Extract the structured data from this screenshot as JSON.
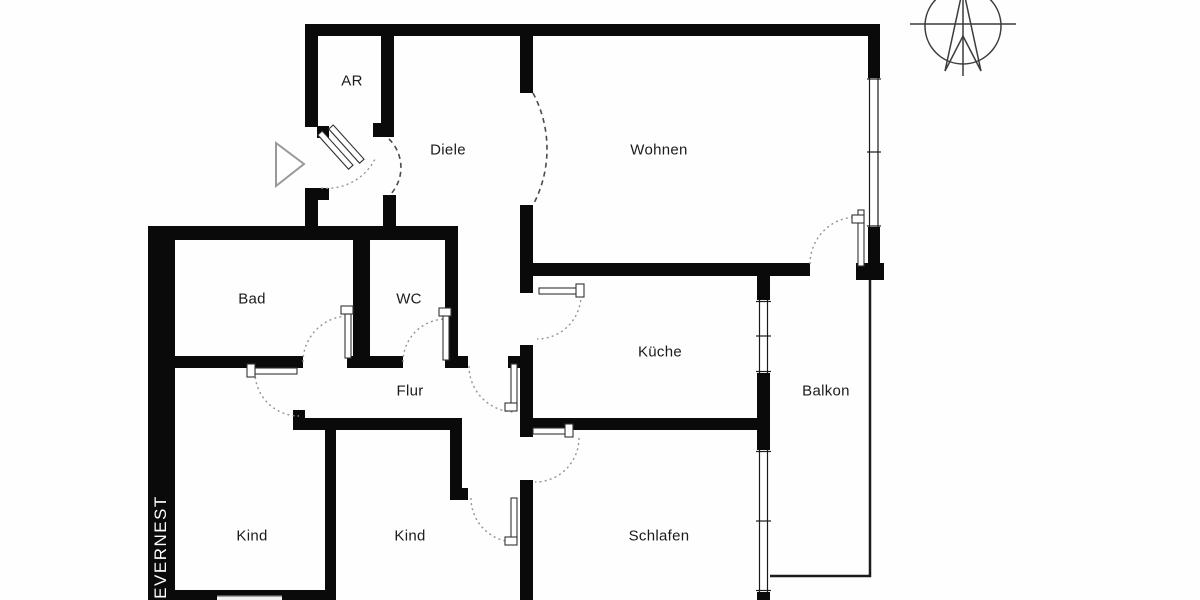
{
  "document": {
    "kind": "apartment floor plan",
    "language": "de"
  },
  "brand": {
    "name": "EVERNEST"
  },
  "rooms": [
    {
      "id": "ar",
      "name": "AR",
      "x": 352,
      "y": 81
    },
    {
      "id": "diele",
      "name": "Diele",
      "x": 448,
      "y": 150
    },
    {
      "id": "wohnen",
      "name": "Wohnen",
      "x": 659,
      "y": 150
    },
    {
      "id": "bad",
      "name": "Bad",
      "x": 252,
      "y": 299
    },
    {
      "id": "wc",
      "name": "WC",
      "x": 409,
      "y": 299
    },
    {
      "id": "kueche",
      "name": "Küche",
      "x": 660,
      "y": 352
    },
    {
      "id": "flur",
      "name": "Flur",
      "x": 410,
      "y": 391
    },
    {
      "id": "balkon",
      "name": "Balkon",
      "x": 826,
      "y": 391
    },
    {
      "id": "kind-1",
      "name": "Kind",
      "x": 252,
      "y": 536
    },
    {
      "id": "kind-2",
      "name": "Kind",
      "x": 410,
      "y": 536
    },
    {
      "id": "schlafen",
      "name": "Schlafen",
      "x": 659,
      "y": 536
    }
  ],
  "icons": {
    "compass": "compass-rose-icon (north arrow, top right)",
    "entrance": "entrance-arrow-icon (triangle marking the apartment entry door)"
  },
  "colors": {
    "wall": "#0a0a0a",
    "background": "#fefefe",
    "door_arc": "#949494",
    "passage_arc": "#4a4a4a",
    "label_text": "#1b1b1b",
    "brand_text": "#ffffff"
  }
}
